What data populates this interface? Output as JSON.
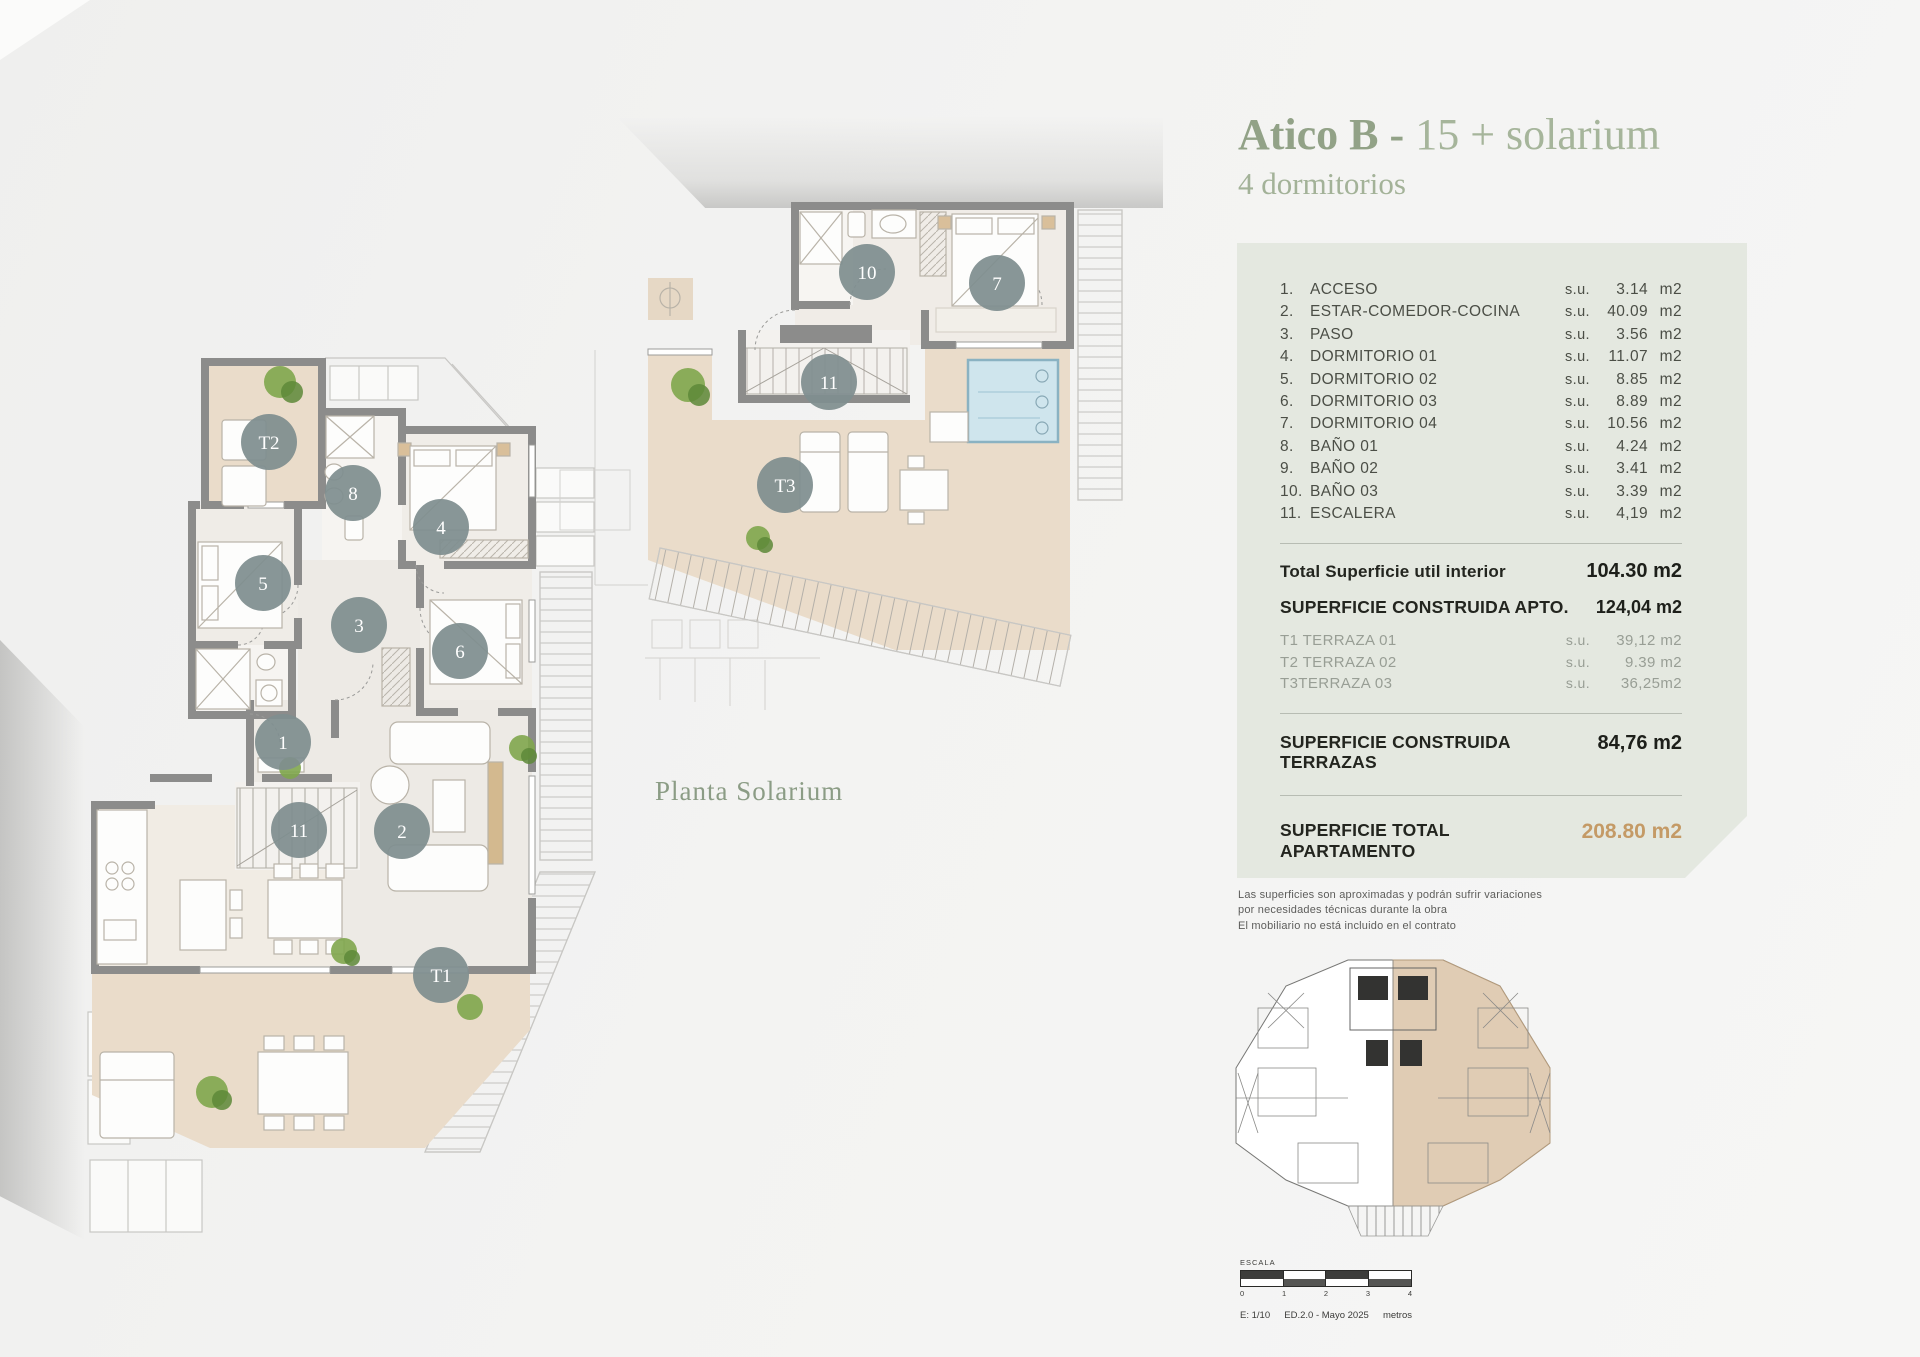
{
  "header": {
    "title_bold": "Atico B -",
    "title_light": " 15 + solarium",
    "subtitle": "4 dormitorios"
  },
  "captions": {
    "solarium": "Planta Solarium"
  },
  "surface_panel": {
    "rooms": [
      {
        "num": "1.",
        "label": "ACCESO",
        "su": "s.u.",
        "value": "3.14",
        "unit": "m2"
      },
      {
        "num": "2.",
        "label": "ESTAR-COMEDOR-COCINA",
        "su": "s.u.",
        "value": "40.09",
        "unit": "m2"
      },
      {
        "num": "3.",
        "label": "PASO",
        "su": "s.u.",
        "value": "3.56",
        "unit": "m2"
      },
      {
        "num": "4.",
        "label": "DORMITORIO 01",
        "su": "s.u.",
        "value": "11.07",
        "unit": "m2"
      },
      {
        "num": "5.",
        "label": "DORMITORIO 02",
        "su": "s.u.",
        "value": "8.85",
        "unit": "m2"
      },
      {
        "num": "6.",
        "label": "DORMITORIO 03",
        "su": "s.u.",
        "value": "8.89",
        "unit": "m2"
      },
      {
        "num": "7.",
        "label": "DORMITORIO 04",
        "su": "s.u.",
        "value": "10.56",
        "unit": "m2"
      },
      {
        "num": "8.",
        "label": "BAÑO 01",
        "su": "s.u.",
        "value": "4.24",
        "unit": "m2"
      },
      {
        "num": "9.",
        "label": "BAÑO 02",
        "su": "s.u.",
        "value": "3.41",
        "unit": "m2"
      },
      {
        "num": "10.",
        "label": "BAÑO 03",
        "su": "s.u.",
        "value": "3.39",
        "unit": "m2"
      },
      {
        "num": "11.",
        "label": "ESCALERA",
        "su": "s.u.",
        "value": "4,19",
        "unit": "m2"
      }
    ],
    "total_interior": {
      "label": "Total Superficie util interior",
      "value": "104.30 m2"
    },
    "constructed_apto": {
      "label": "SUPERFICIE CONSTRUIDA APTO.",
      "value": "124,04 m2"
    },
    "terraces": [
      {
        "label": "T1 TERRAZA 01",
        "su": "s.u.",
        "value": "39,12 m2"
      },
      {
        "label": "T2 TERRAZA 02",
        "su": "s.u.",
        "value": "9.39 m2"
      },
      {
        "label": "T3TERRAZA 03",
        "su": "s.u.",
        "value": "36,25m2"
      }
    ],
    "constructed_terraces": {
      "label_line1": "SUPERFICIE CONSTRUIDA",
      "label_line2": "TERRAZAS",
      "value": "84,76 m2"
    },
    "total_apartment": {
      "label_line1": "SUPERFICIE TOTAL",
      "label_line2": "APARTAMENTO",
      "value": "208.80 m2"
    }
  },
  "disclaimer": {
    "line1": "Las superficies son aproximadas y podrán sufrir variaciones",
    "line2": "por necesidades técnicas durante la obra",
    "line3": "El mobiliario no está incluido en el contrato"
  },
  "badges": {
    "main": [
      "T2",
      "8",
      "4",
      "5",
      "3",
      "6",
      "1",
      "11",
      "2",
      "T1"
    ],
    "solarium": [
      "10",
      "7",
      "11",
      "T3"
    ]
  },
  "scalebar": {
    "label": "ESCALA",
    "ticks": [
      "0",
      "1",
      "2",
      "3",
      "4"
    ],
    "scale_text": "E: 1/10",
    "edition": "ED.2.0 - Mayo 2025",
    "unit": "metros"
  },
  "colors": {
    "accent_green": "#92a287",
    "panel_bg": "#e4e8e0",
    "total_highlight": "#c49a66",
    "badge_gray": "#7f8e8f",
    "terrace_beige": "#eadcca",
    "wall_gray": "#8c8c8b",
    "pool_blue": "#cfe5ed",
    "keyplan_tan": "#d9c1a3"
  }
}
